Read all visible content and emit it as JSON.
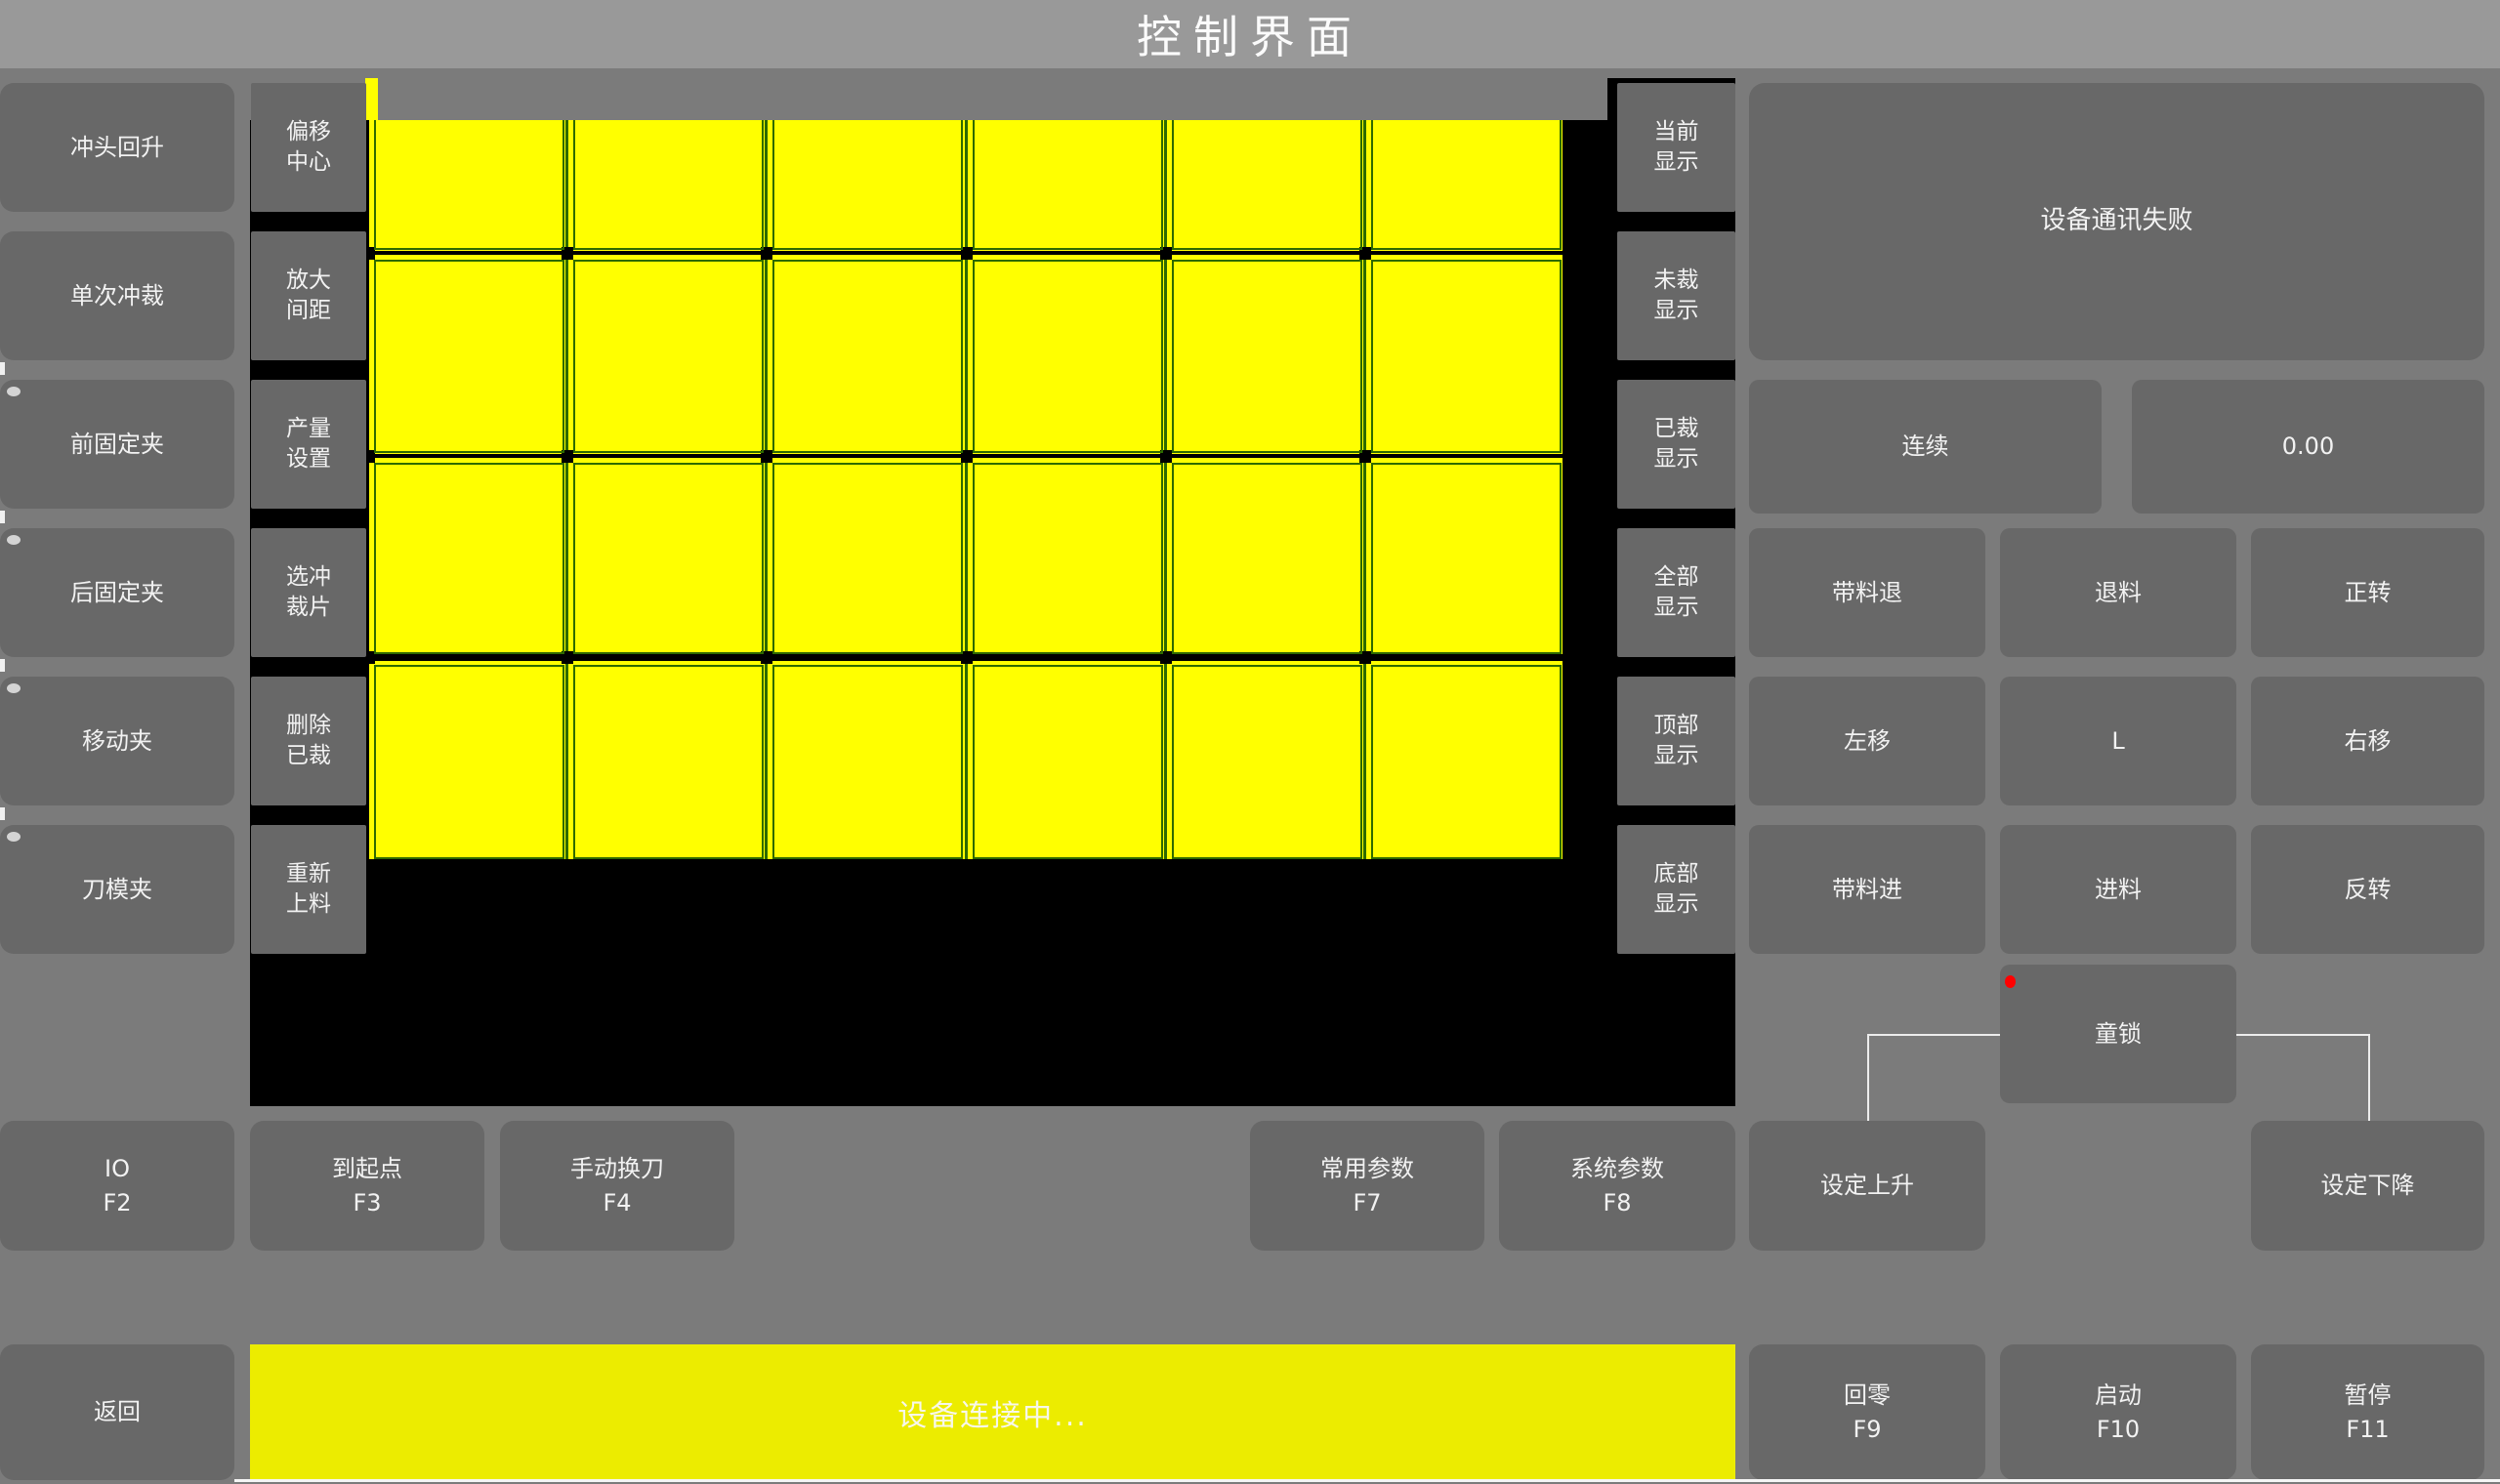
{
  "title": "控制界面",
  "colors": {
    "titlebar_bg": "#999999",
    "page_bg": "#7b7b7b",
    "button_bg": "#686868",
    "canvas_bg": "#000000",
    "sheet_yellow": "#ffff00",
    "status_bar_yellow": "#ecec00",
    "grid_line": "#2e6a00",
    "cell_border": "#2e6a00",
    "separator_black": "#000000",
    "indicator_red": "#ff0000",
    "text": "#f2f2f2"
  },
  "left_panel": {
    "buttons": [
      {
        "label": "冲头回升",
        "has_indicator": false
      },
      {
        "label": "单次冲裁",
        "has_indicator": false
      },
      {
        "label": "前固定夹",
        "has_indicator": true
      },
      {
        "label": "后固定夹",
        "has_indicator": true
      },
      {
        "label": "移动夹",
        "has_indicator": true
      },
      {
        "label": "刀模夹",
        "has_indicator": true
      }
    ]
  },
  "tool_panel": {
    "buttons": [
      {
        "line1": "偏移",
        "line2": "中心"
      },
      {
        "line1": "放大",
        "line2": "间距"
      },
      {
        "line1": "产量",
        "line2": "设置"
      },
      {
        "line1": "选冲",
        "line2": "裁片"
      },
      {
        "line1": "删除",
        "line2": "已裁"
      },
      {
        "line1": "重新",
        "line2": "上料"
      }
    ]
  },
  "display_panel": {
    "buttons": [
      {
        "line1": "当前",
        "line2": "显示"
      },
      {
        "line1": "未裁",
        "line2": "显示"
      },
      {
        "line1": "已裁",
        "line2": "显示"
      },
      {
        "line1": "全部",
        "line2": "显示"
      },
      {
        "line1": "顶部",
        "line2": "显示"
      },
      {
        "line1": "底部",
        "line2": "显示"
      }
    ]
  },
  "grid": {
    "rows": 4,
    "columns": 6
  },
  "right_panel": {
    "message": "设备通讯失败",
    "mode_button": "连续",
    "value_display": "0.00",
    "jog_buttons": [
      "带料退",
      "退料",
      "正转",
      "左移",
      "L",
      "右移",
      "带料进",
      "进料",
      "反转"
    ],
    "child_lock_button": "童锁"
  },
  "function_row": {
    "io": {
      "label": "IO",
      "key": "F2"
    },
    "to_origin": {
      "label": "到起点",
      "key": "F3"
    },
    "manual_tool_change": {
      "label": "手动换刀",
      "key": "F4"
    },
    "common_params": {
      "label": "常用参数",
      "key": "F7"
    },
    "system_params": {
      "label": "系统参数",
      "key": "F8"
    },
    "set_rise": "设定上升",
    "set_fall": "设定下降"
  },
  "bottom_bar": {
    "back": "返回",
    "status": "设备连接中...",
    "home": {
      "label": "回零",
      "key": "F9"
    },
    "start": {
      "label": "启动",
      "key": "F10"
    },
    "pause": {
      "label": "暂停",
      "key": "F11"
    }
  }
}
